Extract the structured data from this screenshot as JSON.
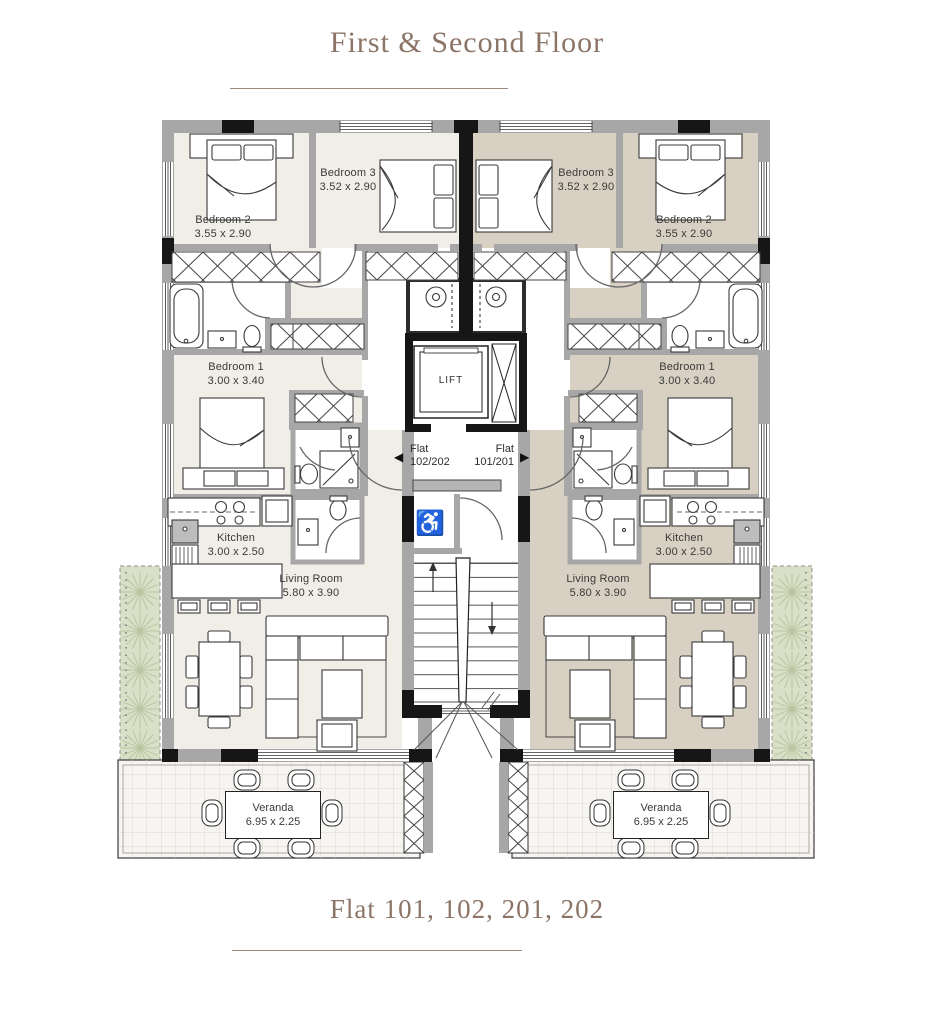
{
  "header": {
    "title": "First & Second Floor"
  },
  "footer": {
    "subtitle": "Flat 101, 102, 201, 202"
  },
  "lift": {
    "label": "LIFT"
  },
  "hall": {
    "left_flat": {
      "name": "Flat",
      "number": "102/202"
    },
    "right_flat": {
      "name": "Flat",
      "number": "101/201"
    }
  },
  "icons": {
    "wheelchair": "♿",
    "arrow_left": "◀",
    "arrow_right": "▶"
  },
  "flats": {
    "left": {
      "rooms": {
        "bedroom2": {
          "label": "Bedroom 2",
          "dims": "3.55 x 2.90"
        },
        "bedroom3": {
          "label": "Bedroom 3",
          "dims": "3.52 x 2.90"
        },
        "bedroom1": {
          "label": "Bedroom 1",
          "dims": "3.00 x 3.40"
        },
        "kitchen": {
          "label": "Kitchen",
          "dims": "3.00 x 2.50"
        },
        "living_room": {
          "label": "Living Room",
          "dims": "5.80 x 3.90"
        },
        "veranda": {
          "label": "Veranda",
          "dims": "6.95 x 2.25"
        }
      }
    },
    "right": {
      "rooms": {
        "bedroom2": {
          "label": "Bedroom 2",
          "dims": "3.55 x 2.90"
        },
        "bedroom3": {
          "label": "Bedroom 3",
          "dims": "3.52 x 2.90"
        },
        "bedroom1": {
          "label": "Bedroom 1",
          "dims": "3.00 x 3.40"
        },
        "kitchen": {
          "label": "Kitchen",
          "dims": "3.00 x 2.50"
        },
        "living_room": {
          "label": "Living Room",
          "dims": "5.80 x 3.90"
        },
        "veranda": {
          "label": "Veranda",
          "dims": "6.95 x 2.25"
        }
      }
    }
  },
  "colors": {
    "accent": "#8c7566",
    "left_flat_floor": "#f1ede7",
    "right_flat_floor": "#d8d0c2",
    "wall_gray": "#a7a7a7",
    "wall_black": "#161616",
    "hedge_green": "#dadfc7"
  }
}
